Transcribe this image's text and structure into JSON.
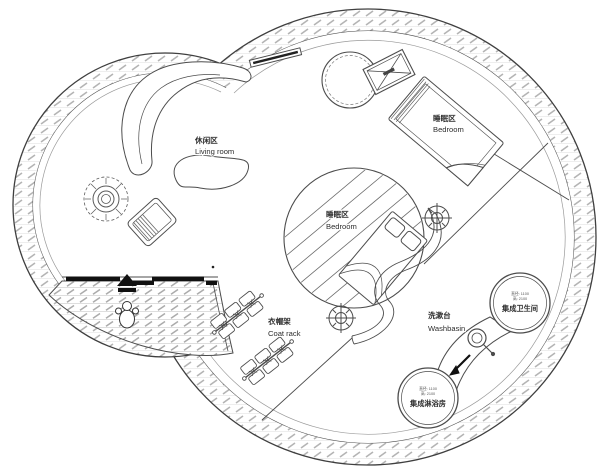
{
  "labels": {
    "living_zone": {
      "zh": "休闲区",
      "en": "Living room"
    },
    "bedroom_upper": {
      "zh": "睡眠区",
      "en": "Bedroom"
    },
    "bedroom_center": {
      "zh": "睡眠区",
      "en": "Bedroom"
    },
    "coat_rack": {
      "zh": "衣帽架",
      "en": "Coat rack"
    },
    "washbasin": {
      "zh": "洗漱台",
      "en": "Washbasin"
    },
    "toilet_pod": {
      "dim_line1": "直径: 1100",
      "dim_line2": "高: 2100",
      "name": "集成卫生间"
    },
    "shower_pod": {
      "dim_line1": "直径: 1100",
      "dim_line2": "高: 2100",
      "name": "集成淋浴房"
    }
  },
  "colors": {
    "line": "#4c4c4c",
    "hatch": "#b4b4b4",
    "dark": "#111111",
    "background": "#ffffff"
  }
}
